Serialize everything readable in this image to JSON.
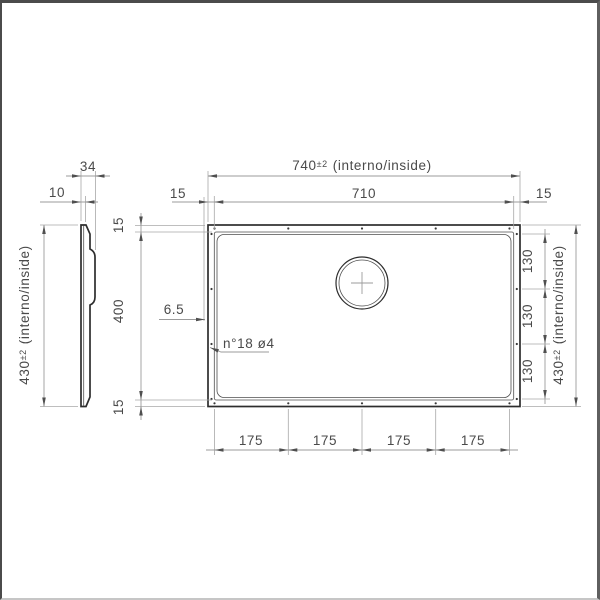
{
  "drawing": {
    "side_view": {
      "depth_total": "34",
      "flange_depth": "10",
      "height_value": "430",
      "height_tol": "±2",
      "height_suffix": "(interno/inside)"
    },
    "plan_view": {
      "width_value": "740",
      "width_tol": "±2",
      "width_suffix": "(interno/inside)",
      "inner_width": "710",
      "margin_left": "15",
      "margin_right": "15",
      "margin_top": "15",
      "inner_height": "400",
      "margin_bottom": "15",
      "height_value": "430",
      "height_tol": "±2",
      "height_suffix": "(interno/inside)",
      "hole_spacing_vertical": [
        "130",
        "130",
        "130"
      ],
      "hole_spacing_horizontal": [
        "175",
        "175",
        "175",
        "175"
      ],
      "edge_offset": "6.5",
      "holes_note": "n°18 ø4"
    },
    "colors": {
      "outline": "#2d2d2d",
      "dimension_line": "#9b9b9b",
      "text": "#4a4a4a"
    }
  }
}
